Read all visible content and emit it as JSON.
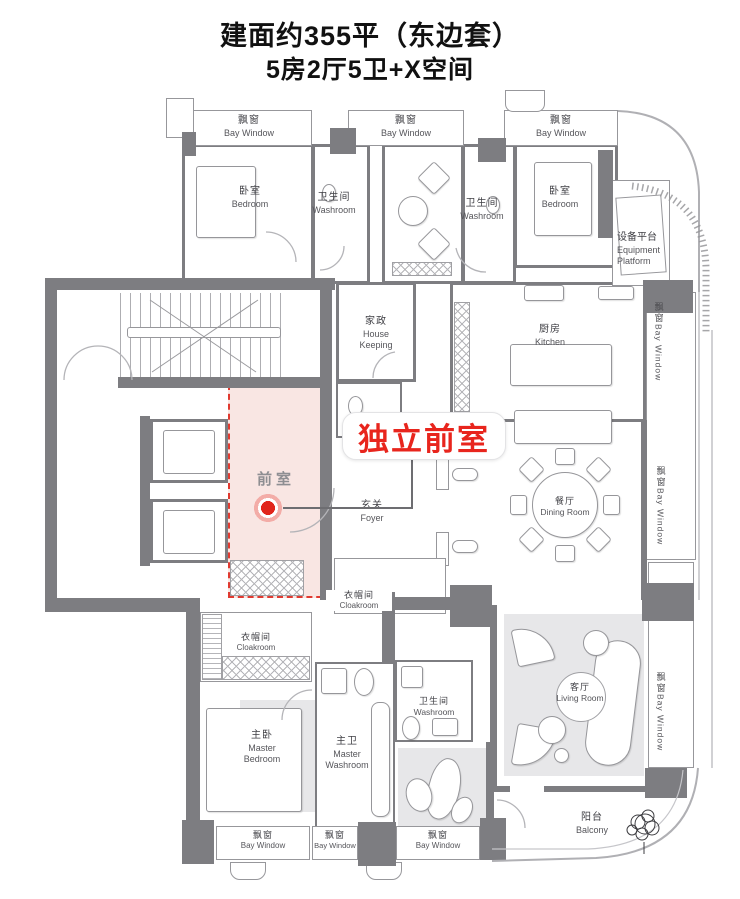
{
  "title": {
    "line1": "建面约355平（东边套）",
    "line2": "5房2厅5卫+X空间"
  },
  "callout": {
    "label": "独立前室"
  },
  "front_room_label": "前室",
  "bay_window": {
    "zh": "飘窗",
    "en": "Bay Window"
  },
  "rooms": {
    "bedroom_left": {
      "zh": "卧室",
      "en": "Bedroom"
    },
    "washroom_top1": {
      "zh": "卫生间",
      "en": "Washroom"
    },
    "washroom_top2": {
      "zh": "卫生间",
      "en": "Washroom"
    },
    "bedroom_right": {
      "zh": "卧室",
      "en": "Bedroom"
    },
    "equipment_platform": {
      "zh": "设备平台",
      "en": "Equipment Platform"
    },
    "housekeeping": {
      "zh": "家政",
      "en": "House Keeping"
    },
    "kitchen": {
      "zh": "厨房",
      "en": "Kitchen"
    },
    "foyer": {
      "zh": "玄关",
      "en": "Foyer"
    },
    "dining": {
      "zh": "餐厅",
      "en": "Dining Room"
    },
    "cloakroom_small": {
      "zh": "衣帽间",
      "en": "Cloakroom"
    },
    "cloakroom": {
      "zh": "衣帽间",
      "en": "Cloakroom"
    },
    "master_bedroom": {
      "zh": "主卧",
      "en": "Master Bedroom"
    },
    "master_washroom": {
      "zh": "主卫",
      "en": "Master Washroom"
    },
    "washroom_bottom": {
      "zh": "卫生间",
      "en": "Washroom"
    },
    "living": {
      "zh": "客厅",
      "en": "Living Room"
    },
    "balcony": {
      "zh": "阳台",
      "en": "Balcony"
    }
  },
  "colors": {
    "wall": "#7d7d81",
    "highlight_fill": "#f9e6e3",
    "highlight_border": "#e03a30",
    "accent_red": "#e8251d",
    "furniture_gray": "#e7e7e9"
  }
}
